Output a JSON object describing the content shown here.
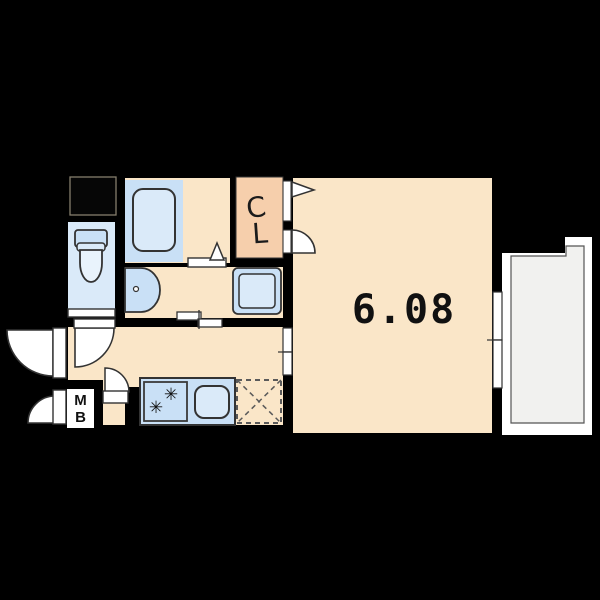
{
  "floorplan": {
    "main_room": {
      "area_label": "6.08"
    },
    "closet": {
      "label_line1": "C",
      "label_line2": "L"
    },
    "meter_box": {
      "label_line1": "M",
      "label_line2": "B"
    },
    "kitchen": {
      "stove_burner_glyph": "✳"
    },
    "colors": {
      "background": "#000000",
      "room_cream": "#FAE6C8",
      "closet_peach": "#F6CFAC",
      "fixture_blue": "#C9E0F6",
      "fixture_blue_light": "#DAEAF9",
      "toilet_room_blue": "#DAEAF9",
      "balcony_gray": "#F1F1EF",
      "door_white": "#FFFFFF",
      "outline": "#333333"
    },
    "fixture_icons": [
      "bathtub-icon",
      "toilet-icon",
      "washbasin-icon",
      "washing-machine-pan-icon",
      "kitchen-counter-icon",
      "gas-stove-icon",
      "kitchen-sink-icon",
      "refrigerator-space-icon",
      "closet",
      "meter-box",
      "balcony",
      "sliding-window-icon",
      "swing-door-icon"
    ]
  }
}
